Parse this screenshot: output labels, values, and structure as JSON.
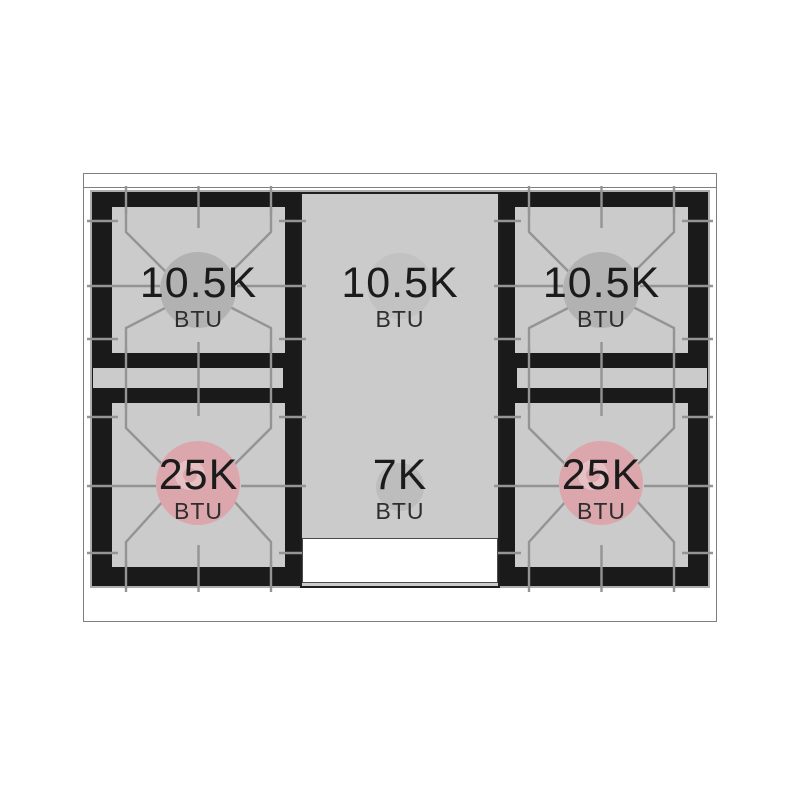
{
  "burners": [
    {
      "position": "top-left",
      "value": "10.5K",
      "unit": "BTU",
      "circle_color": "#b2b2b2"
    },
    {
      "position": "top-center",
      "value": "10.5K",
      "unit": "BTU",
      "circle_color": "#c2c2c2"
    },
    {
      "position": "top-right",
      "value": "10.5K",
      "unit": "BTU",
      "circle_color": "#b2b2b2"
    },
    {
      "position": "bottom-left",
      "value": "25K",
      "unit": "BTU",
      "circle_color": "#dba7ac"
    },
    {
      "position": "bottom-center",
      "value": "7K",
      "unit": "BTU",
      "circle_color": "#bdbdbd"
    },
    {
      "position": "bottom-right",
      "value": "25K",
      "unit": "BTU",
      "circle_color": "#dba7ac"
    }
  ],
  "colors": {
    "background": "#ffffff",
    "cooktop_surface": "#cbcbcb",
    "grate_frame_black": "#1a1a1a",
    "grate_line_gray": "#949494",
    "high_power_burner_pink": "#dba7ac",
    "burner_cap_gray": "#b2b2b2",
    "text": "#1b1b1b"
  }
}
